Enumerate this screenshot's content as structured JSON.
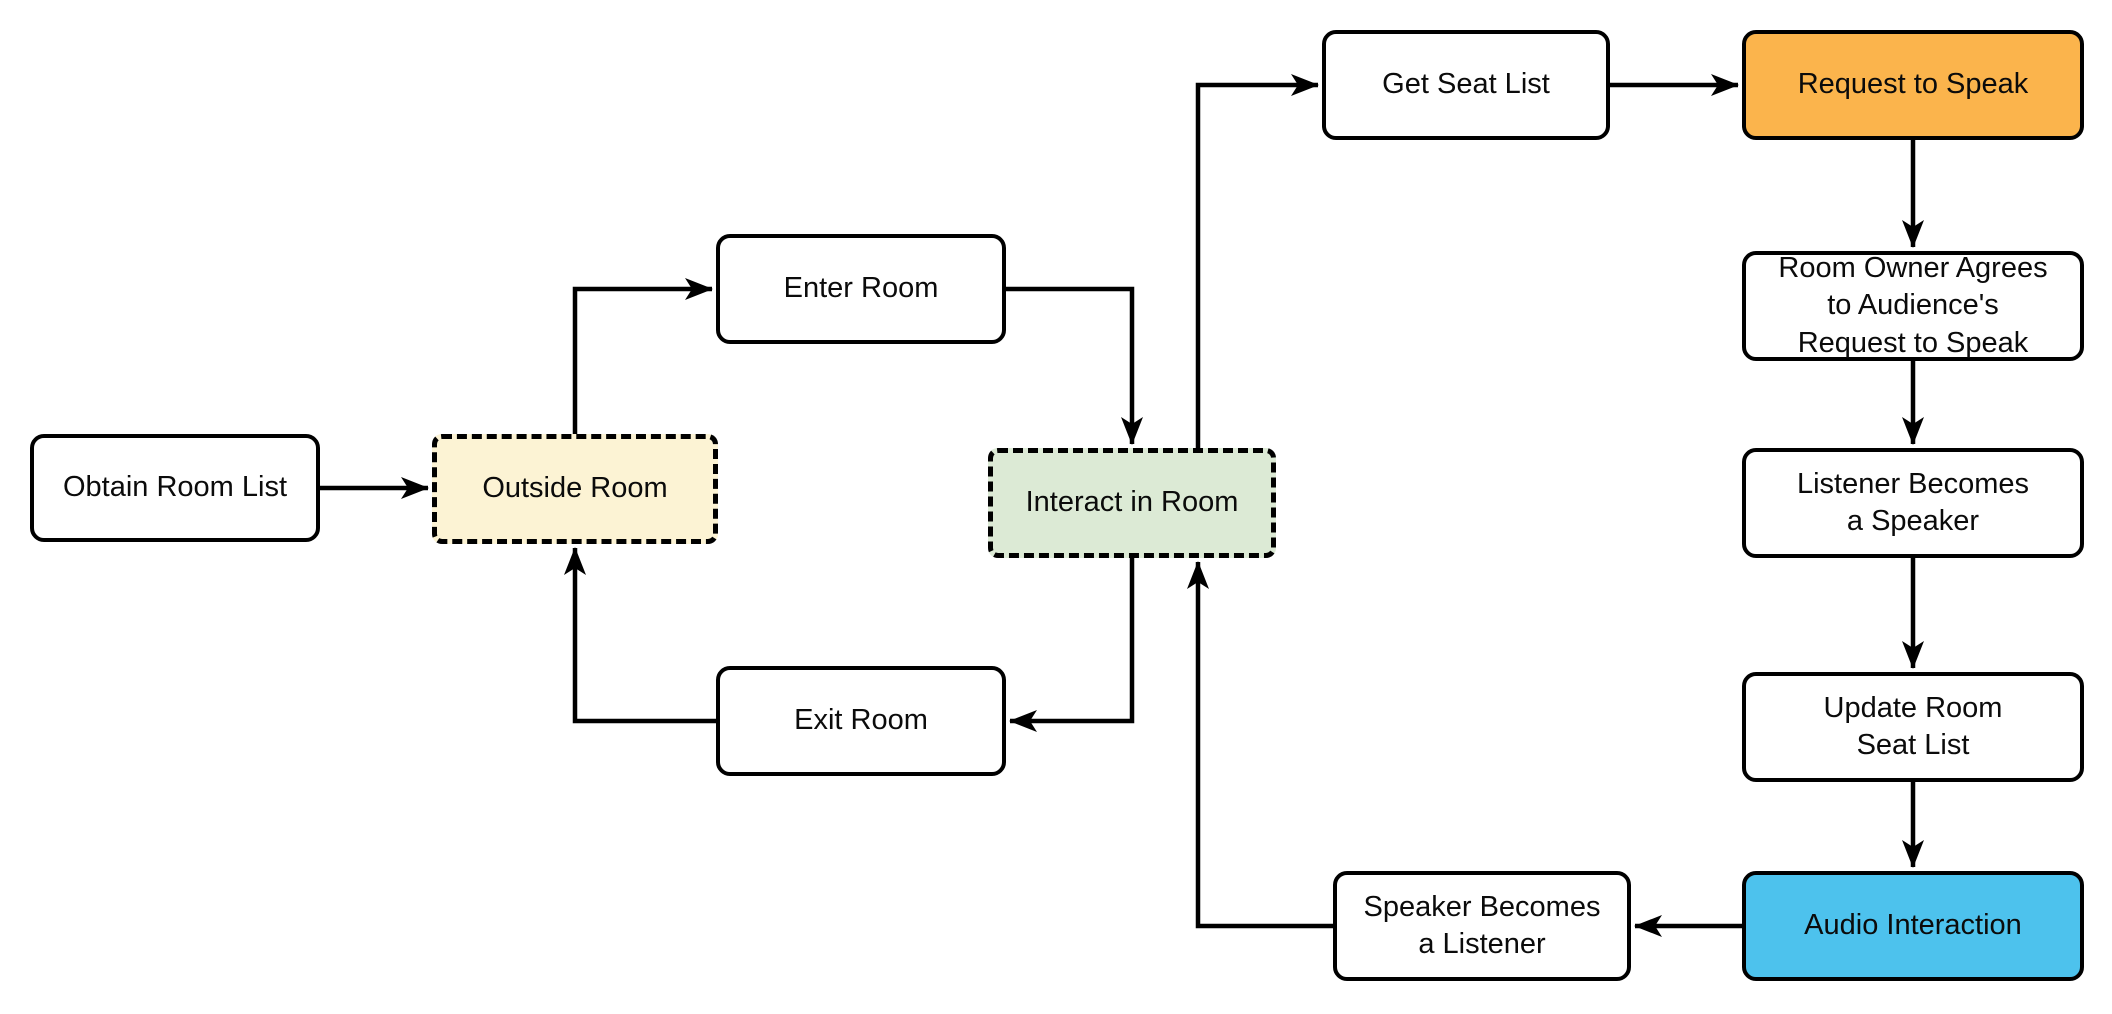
{
  "diagram": {
    "background_color": "#ffffff",
    "line_color": "#000000",
    "text_color": "#0b0b0b",
    "nodes": [
      {
        "id": "obtain-room-list",
        "label": "Obtain Room List",
        "fill": "#ffffff",
        "border": "solid"
      },
      {
        "id": "outside-room",
        "label": "Outside Room",
        "fill": "#fcf3d4",
        "border": "dashed"
      },
      {
        "id": "enter-room",
        "label": "Enter Room",
        "fill": "#ffffff",
        "border": "solid"
      },
      {
        "id": "interact-in-room",
        "label": "Interact in Room",
        "fill": "#dcead5",
        "border": "dashed"
      },
      {
        "id": "exit-room",
        "label": "Exit Room",
        "fill": "#ffffff",
        "border": "solid"
      },
      {
        "id": "get-seat-list",
        "label": "Get Seat List",
        "fill": "#ffffff",
        "border": "solid"
      },
      {
        "id": "request-to-speak",
        "label": "Request to Speak",
        "fill": "#fbb44c",
        "border": "solid"
      },
      {
        "id": "room-owner-agrees",
        "label": "Room Owner Agrees\nto Audience's\nRequest to Speak",
        "fill": "#ffffff",
        "border": "solid"
      },
      {
        "id": "listener-becomes-speaker",
        "label": "Listener Becomes\na Speaker",
        "fill": "#ffffff",
        "border": "solid"
      },
      {
        "id": "update-room-seat-list",
        "label": "Update Room\nSeat List",
        "fill": "#ffffff",
        "border": "solid"
      },
      {
        "id": "audio-interaction",
        "label": "Audio Interaction",
        "fill": "#4dc2ed",
        "border": "solid"
      },
      {
        "id": "speaker-becomes-listener",
        "label": "Speaker Becomes\na Listener",
        "fill": "#ffffff",
        "border": "solid"
      }
    ],
    "edges": [
      {
        "from": "obtain-room-list",
        "to": "outside-room"
      },
      {
        "from": "outside-room",
        "to": "enter-room"
      },
      {
        "from": "enter-room",
        "to": "interact-in-room"
      },
      {
        "from": "interact-in-room",
        "to": "get-seat-list"
      },
      {
        "from": "get-seat-list",
        "to": "request-to-speak"
      },
      {
        "from": "request-to-speak",
        "to": "room-owner-agrees"
      },
      {
        "from": "room-owner-agrees",
        "to": "listener-becomes-speaker"
      },
      {
        "from": "listener-becomes-speaker",
        "to": "update-room-seat-list"
      },
      {
        "from": "update-room-seat-list",
        "to": "audio-interaction"
      },
      {
        "from": "audio-interaction",
        "to": "speaker-becomes-listener"
      },
      {
        "from": "speaker-becomes-listener",
        "to": "interact-in-room"
      },
      {
        "from": "interact-in-room",
        "to": "exit-room"
      },
      {
        "from": "exit-room",
        "to": "outside-room"
      }
    ]
  }
}
